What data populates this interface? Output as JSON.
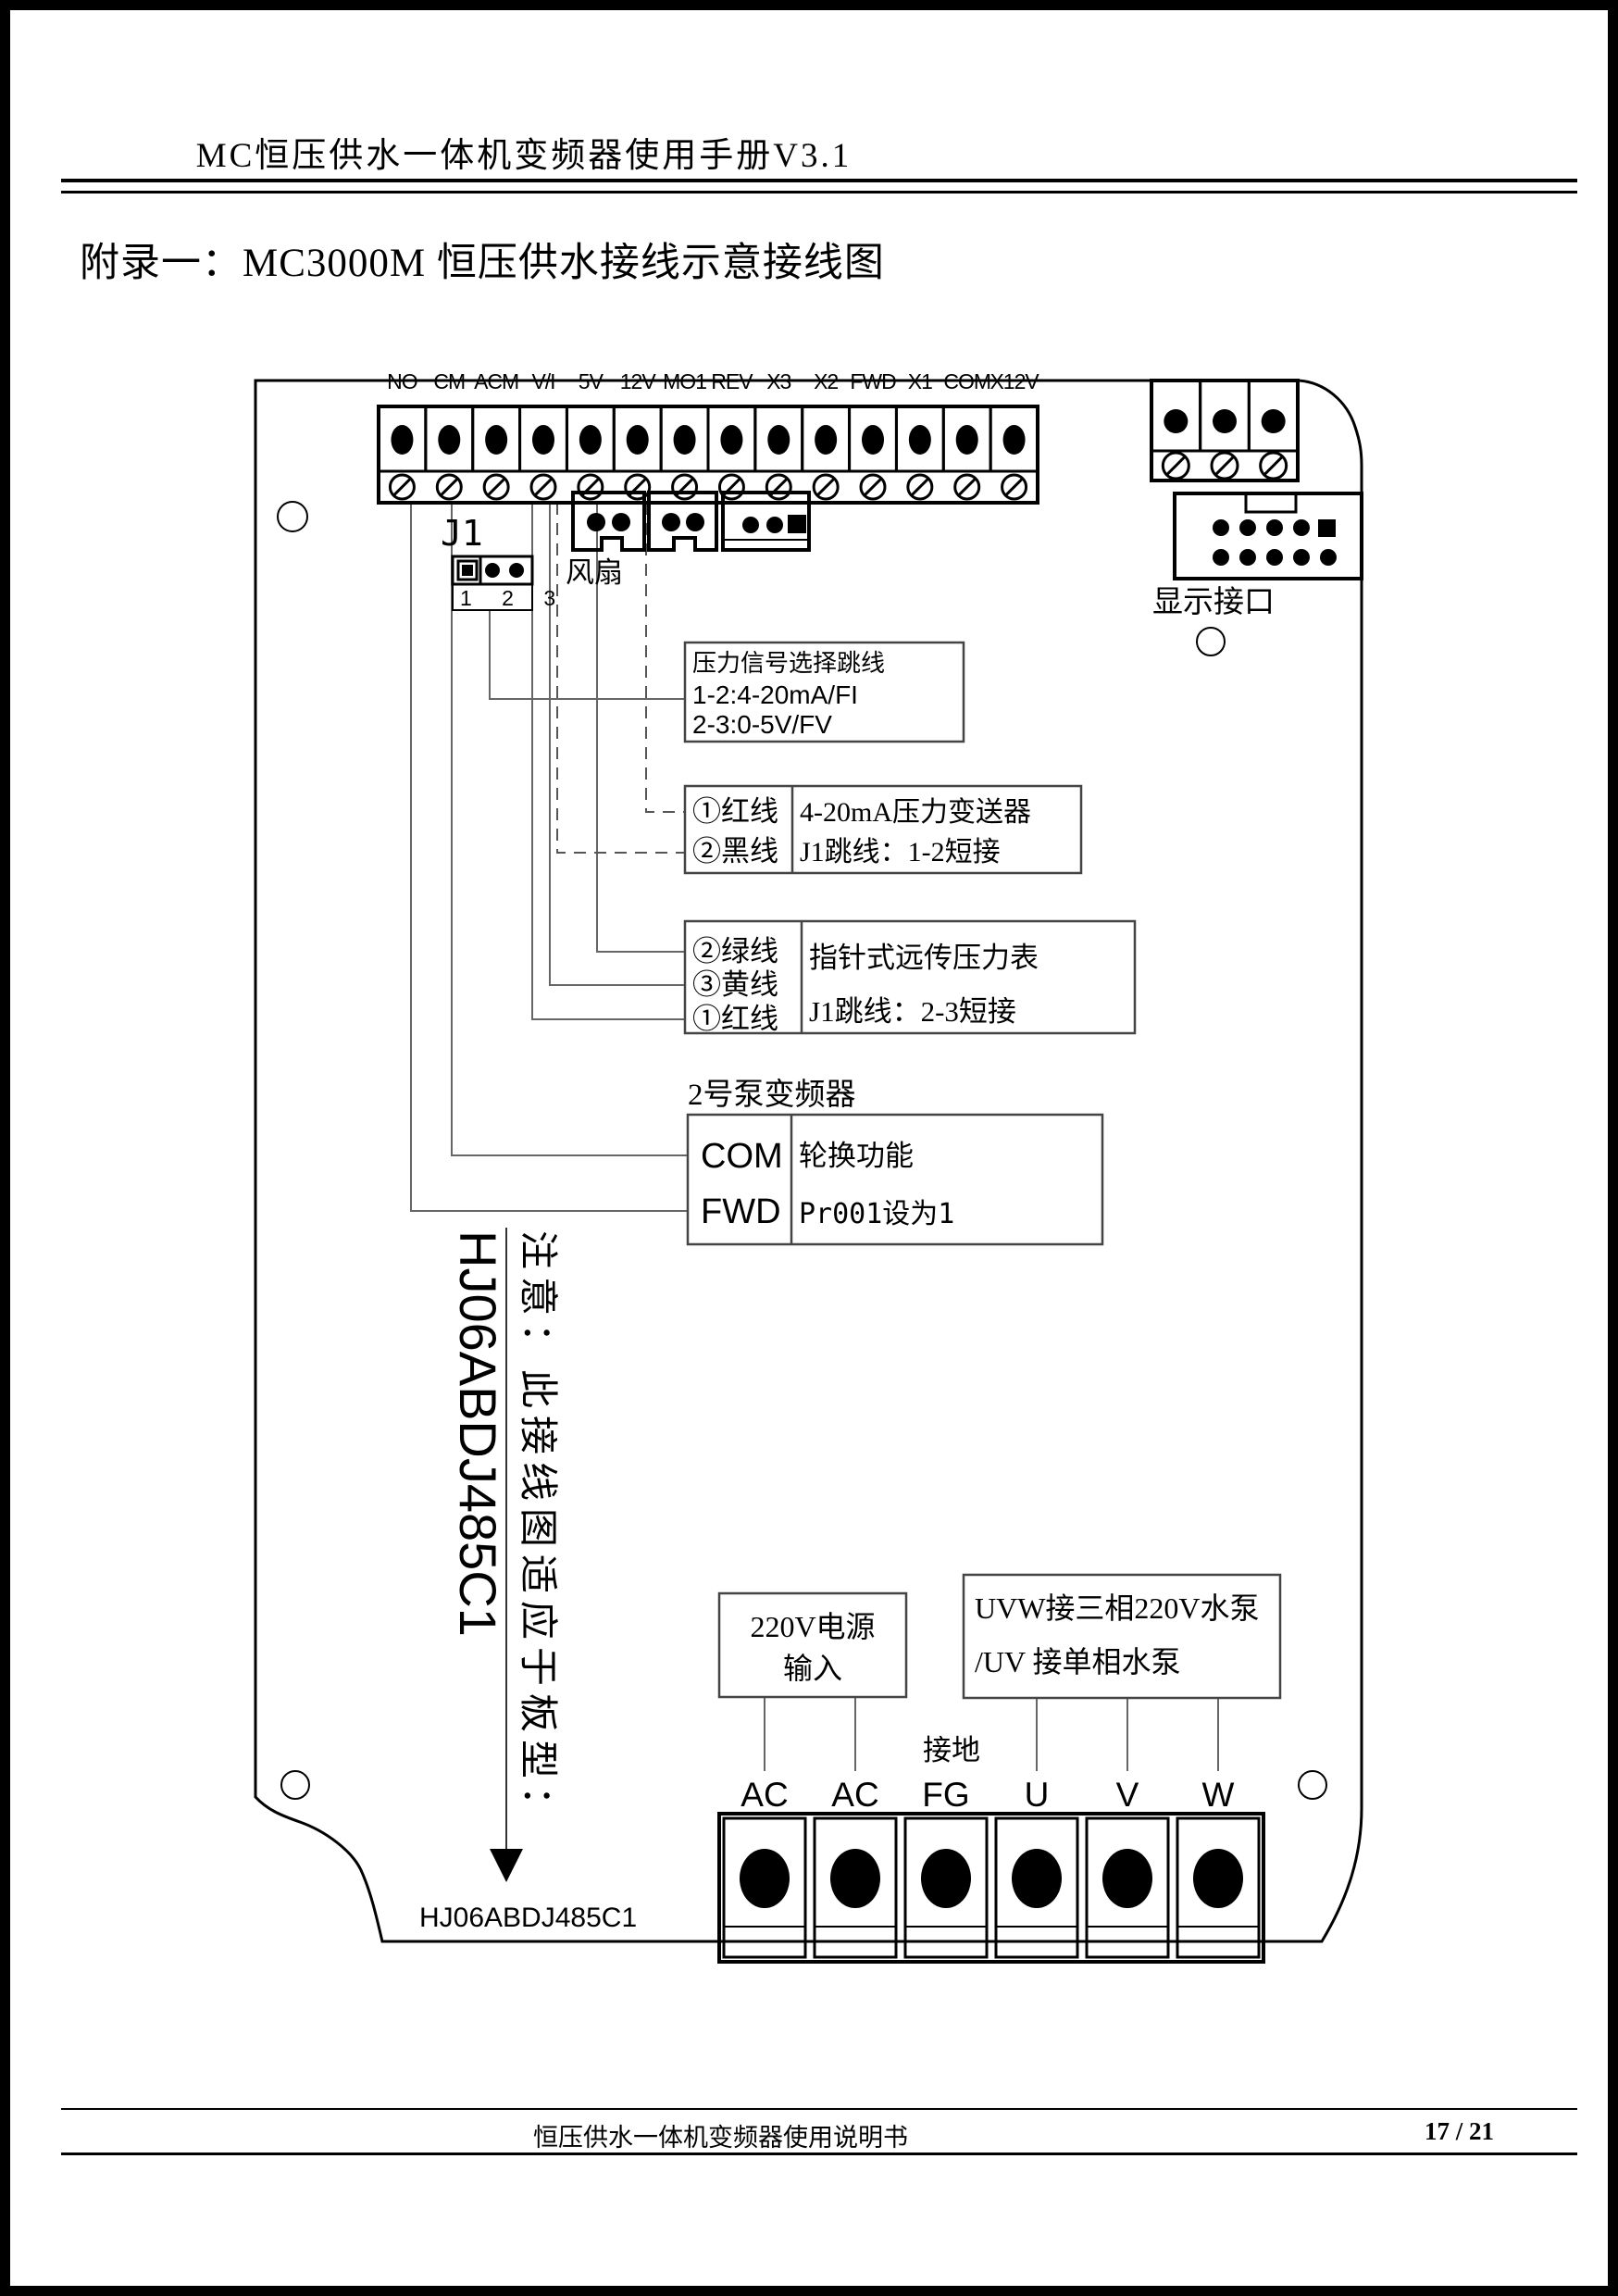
{
  "page": {
    "header_title": "MC恒压供水一体机变频器使用手册V3.1",
    "appendix_title": "附录一：MC3000M 恒压供水接线示意接线图",
    "footer_left": "恒压供水一体机变频器使用说明书",
    "footer_page": "17 / 21"
  },
  "board": {
    "top_terminals": [
      "NO",
      "CM",
      "ACM",
      "V/I",
      "5V",
      "12V",
      "MO1",
      "REV",
      "X3",
      "X2",
      "FWD",
      "X1",
      "COM",
      "X12V"
    ],
    "j1_label": "J1",
    "j1_pins": "1 2 3",
    "fan_label": "风扇",
    "display_label": "显示接口",
    "note_vertical": "注意：此接线图适应于板型：",
    "board_type_vertical": "HJ06ABDJ485C1",
    "board_type_bottom": "HJ06ABDJ485C1",
    "ground_label": "接地",
    "bottom_terminals": [
      "AC",
      "AC",
      "FG",
      "U",
      "V",
      "W"
    ]
  },
  "callouts": {
    "jumper_select": {
      "line1": "压力信号选择跳线",
      "line2": "1-2:4-20mA/FI",
      "line3": "2-3:0-5V/FV"
    },
    "transmitter": {
      "wire1": "①红线",
      "wire2": "②黑线",
      "desc1": "4-20mA压力变送器",
      "desc2": "J1跳线：1-2短接"
    },
    "gauge": {
      "wire1": "②绿线",
      "wire2": "③黄线",
      "wire3": "①红线",
      "desc1": "指针式远传压力表",
      "desc2": "J1跳线：2-3短接"
    },
    "pump2": {
      "title": "2号泵变频器",
      "t1": "COM",
      "t2": "FWD",
      "desc1": "轮换功能",
      "desc2": "Pr001设为1"
    },
    "power_in": {
      "line1": "220V电源",
      "line2": "输入"
    },
    "pump_out": {
      "line1": "UVW接三相220V水泵",
      "line2": "/UV 接单相水泵"
    }
  }
}
